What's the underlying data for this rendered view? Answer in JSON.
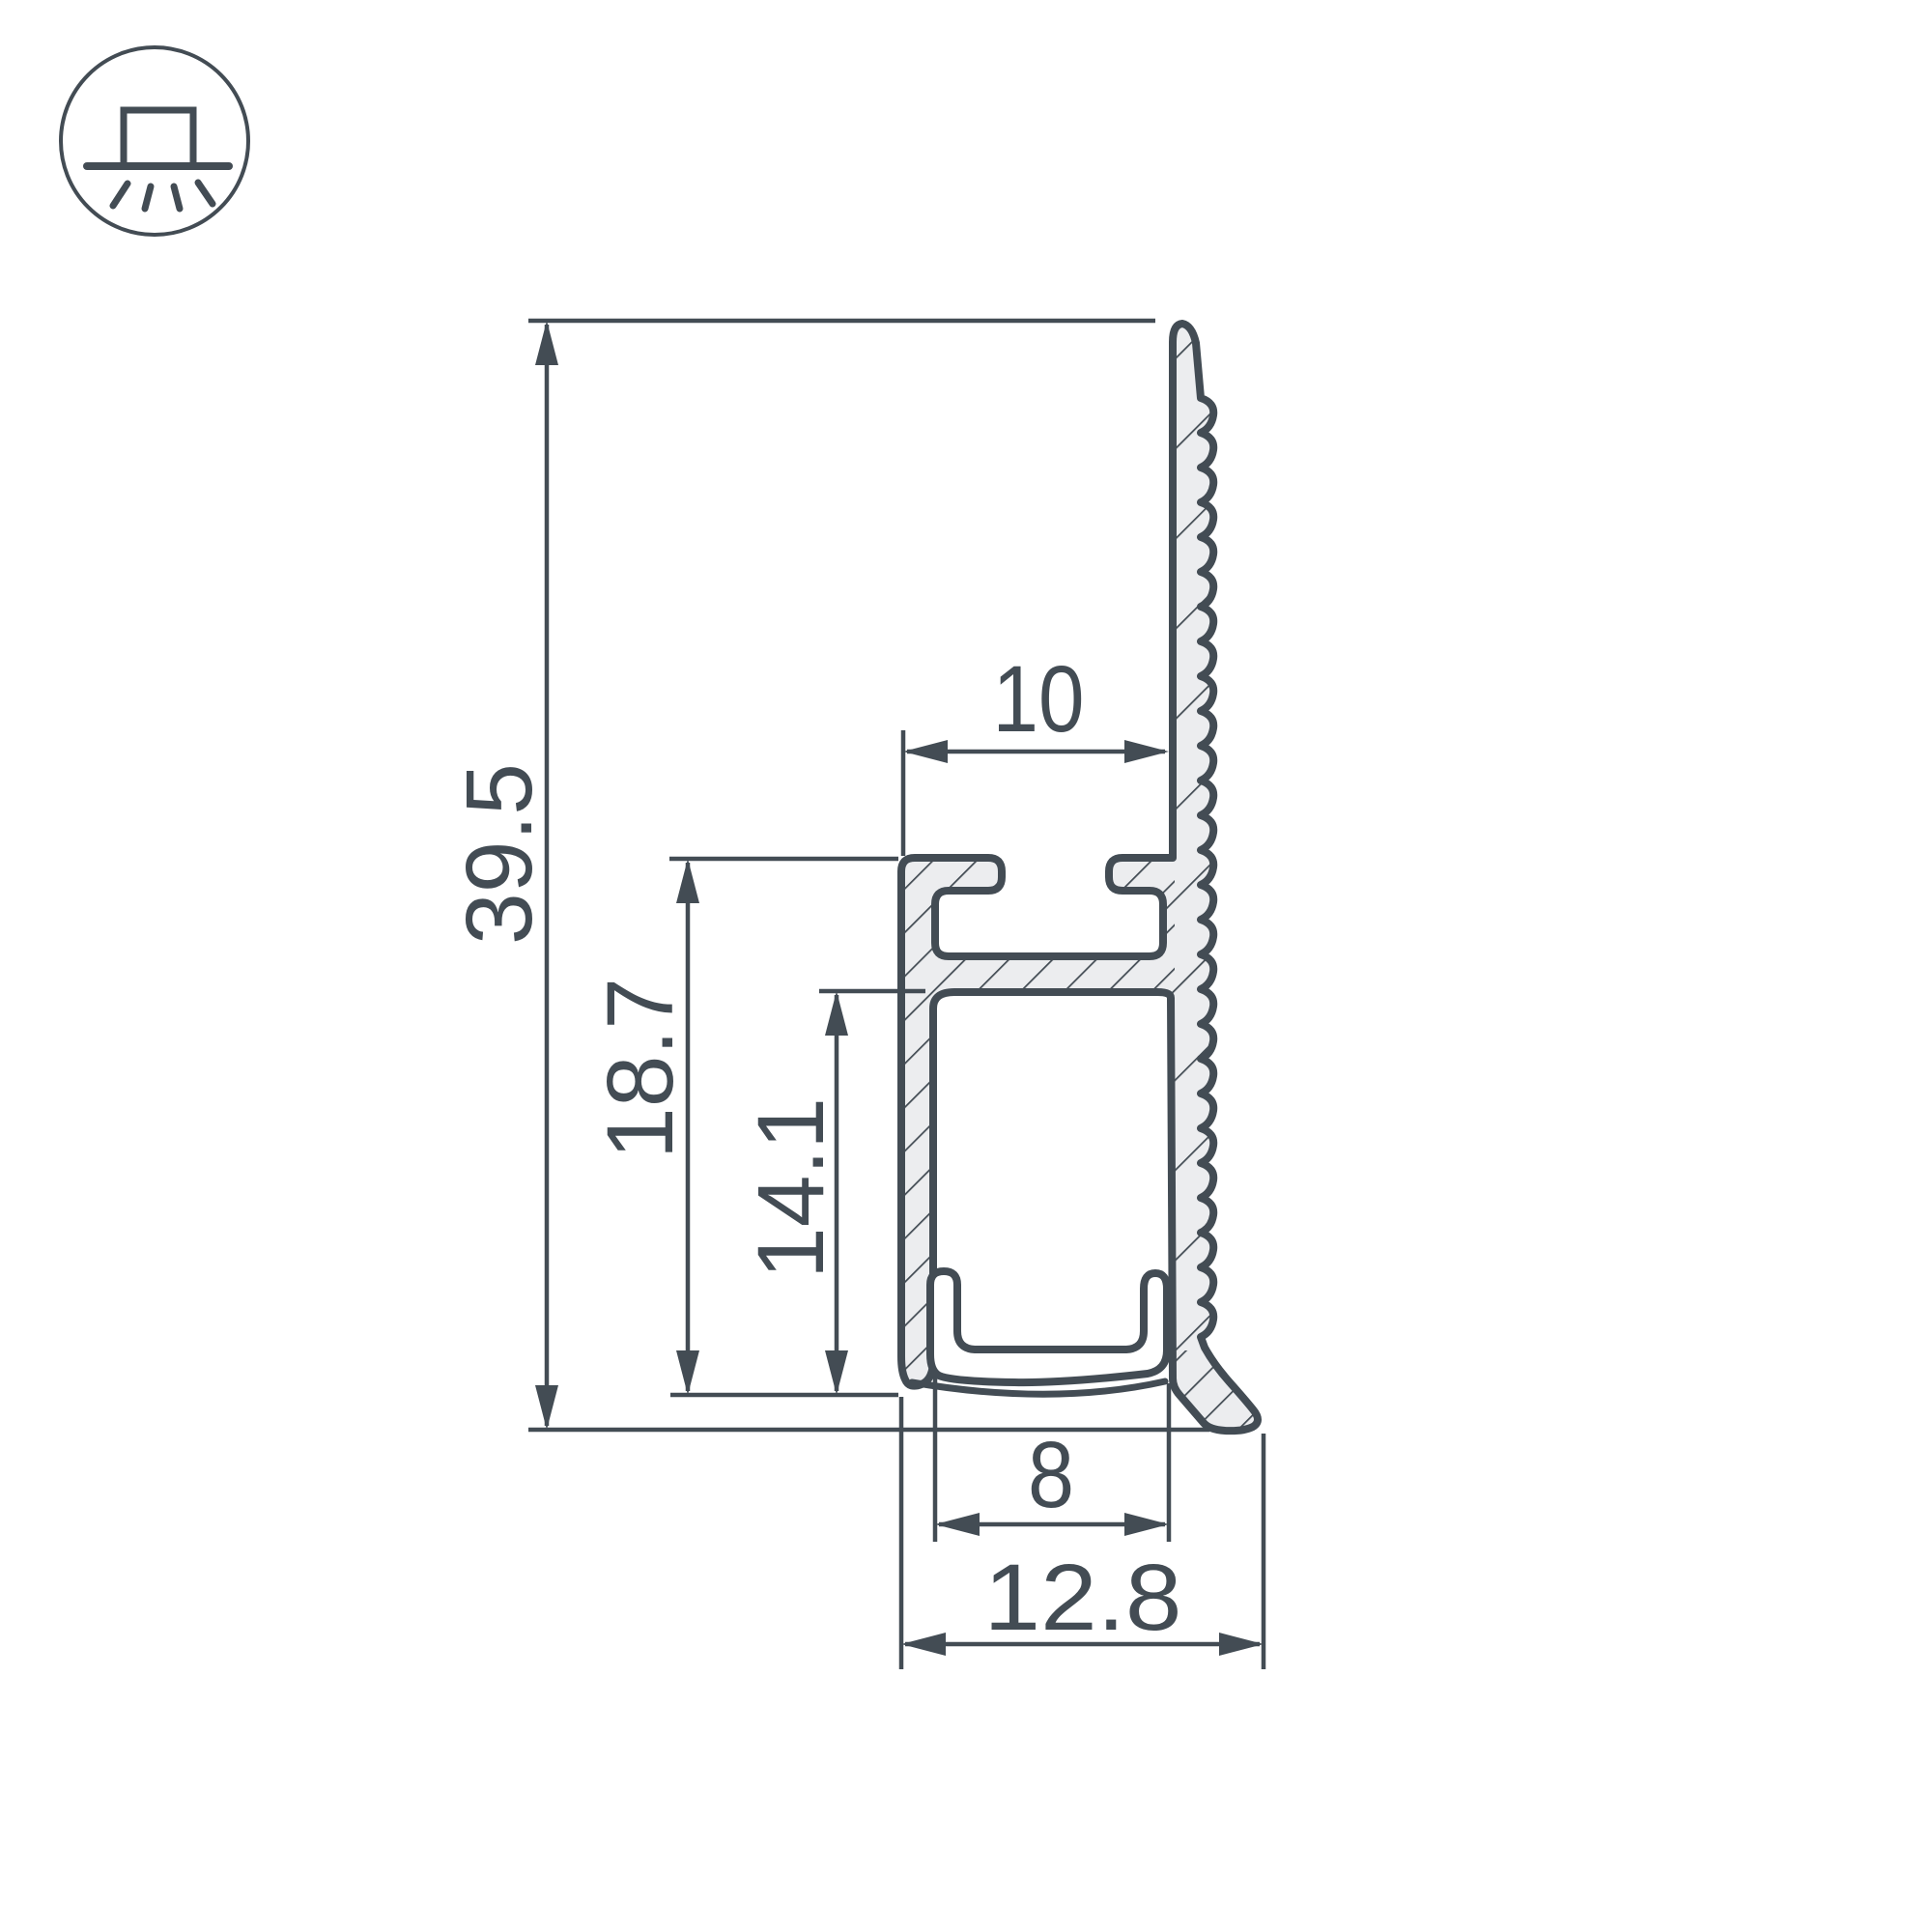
{
  "drawing": {
    "title": "LED profile cross-section dimensional drawing",
    "colors": {
      "line": "#434c54",
      "profile_fill": "#ecedef",
      "background": "#ffffff"
    },
    "icon": {
      "name": "surface-mount-light-icon",
      "description": "circle with square fixture on line and light rays shining down"
    },
    "dimensions": {
      "overall_height": "39.5",
      "body_height": "18.7",
      "channel_height": "14.1",
      "groove_width": "10",
      "channel_width": "8",
      "overall_width": "12.8"
    }
  }
}
